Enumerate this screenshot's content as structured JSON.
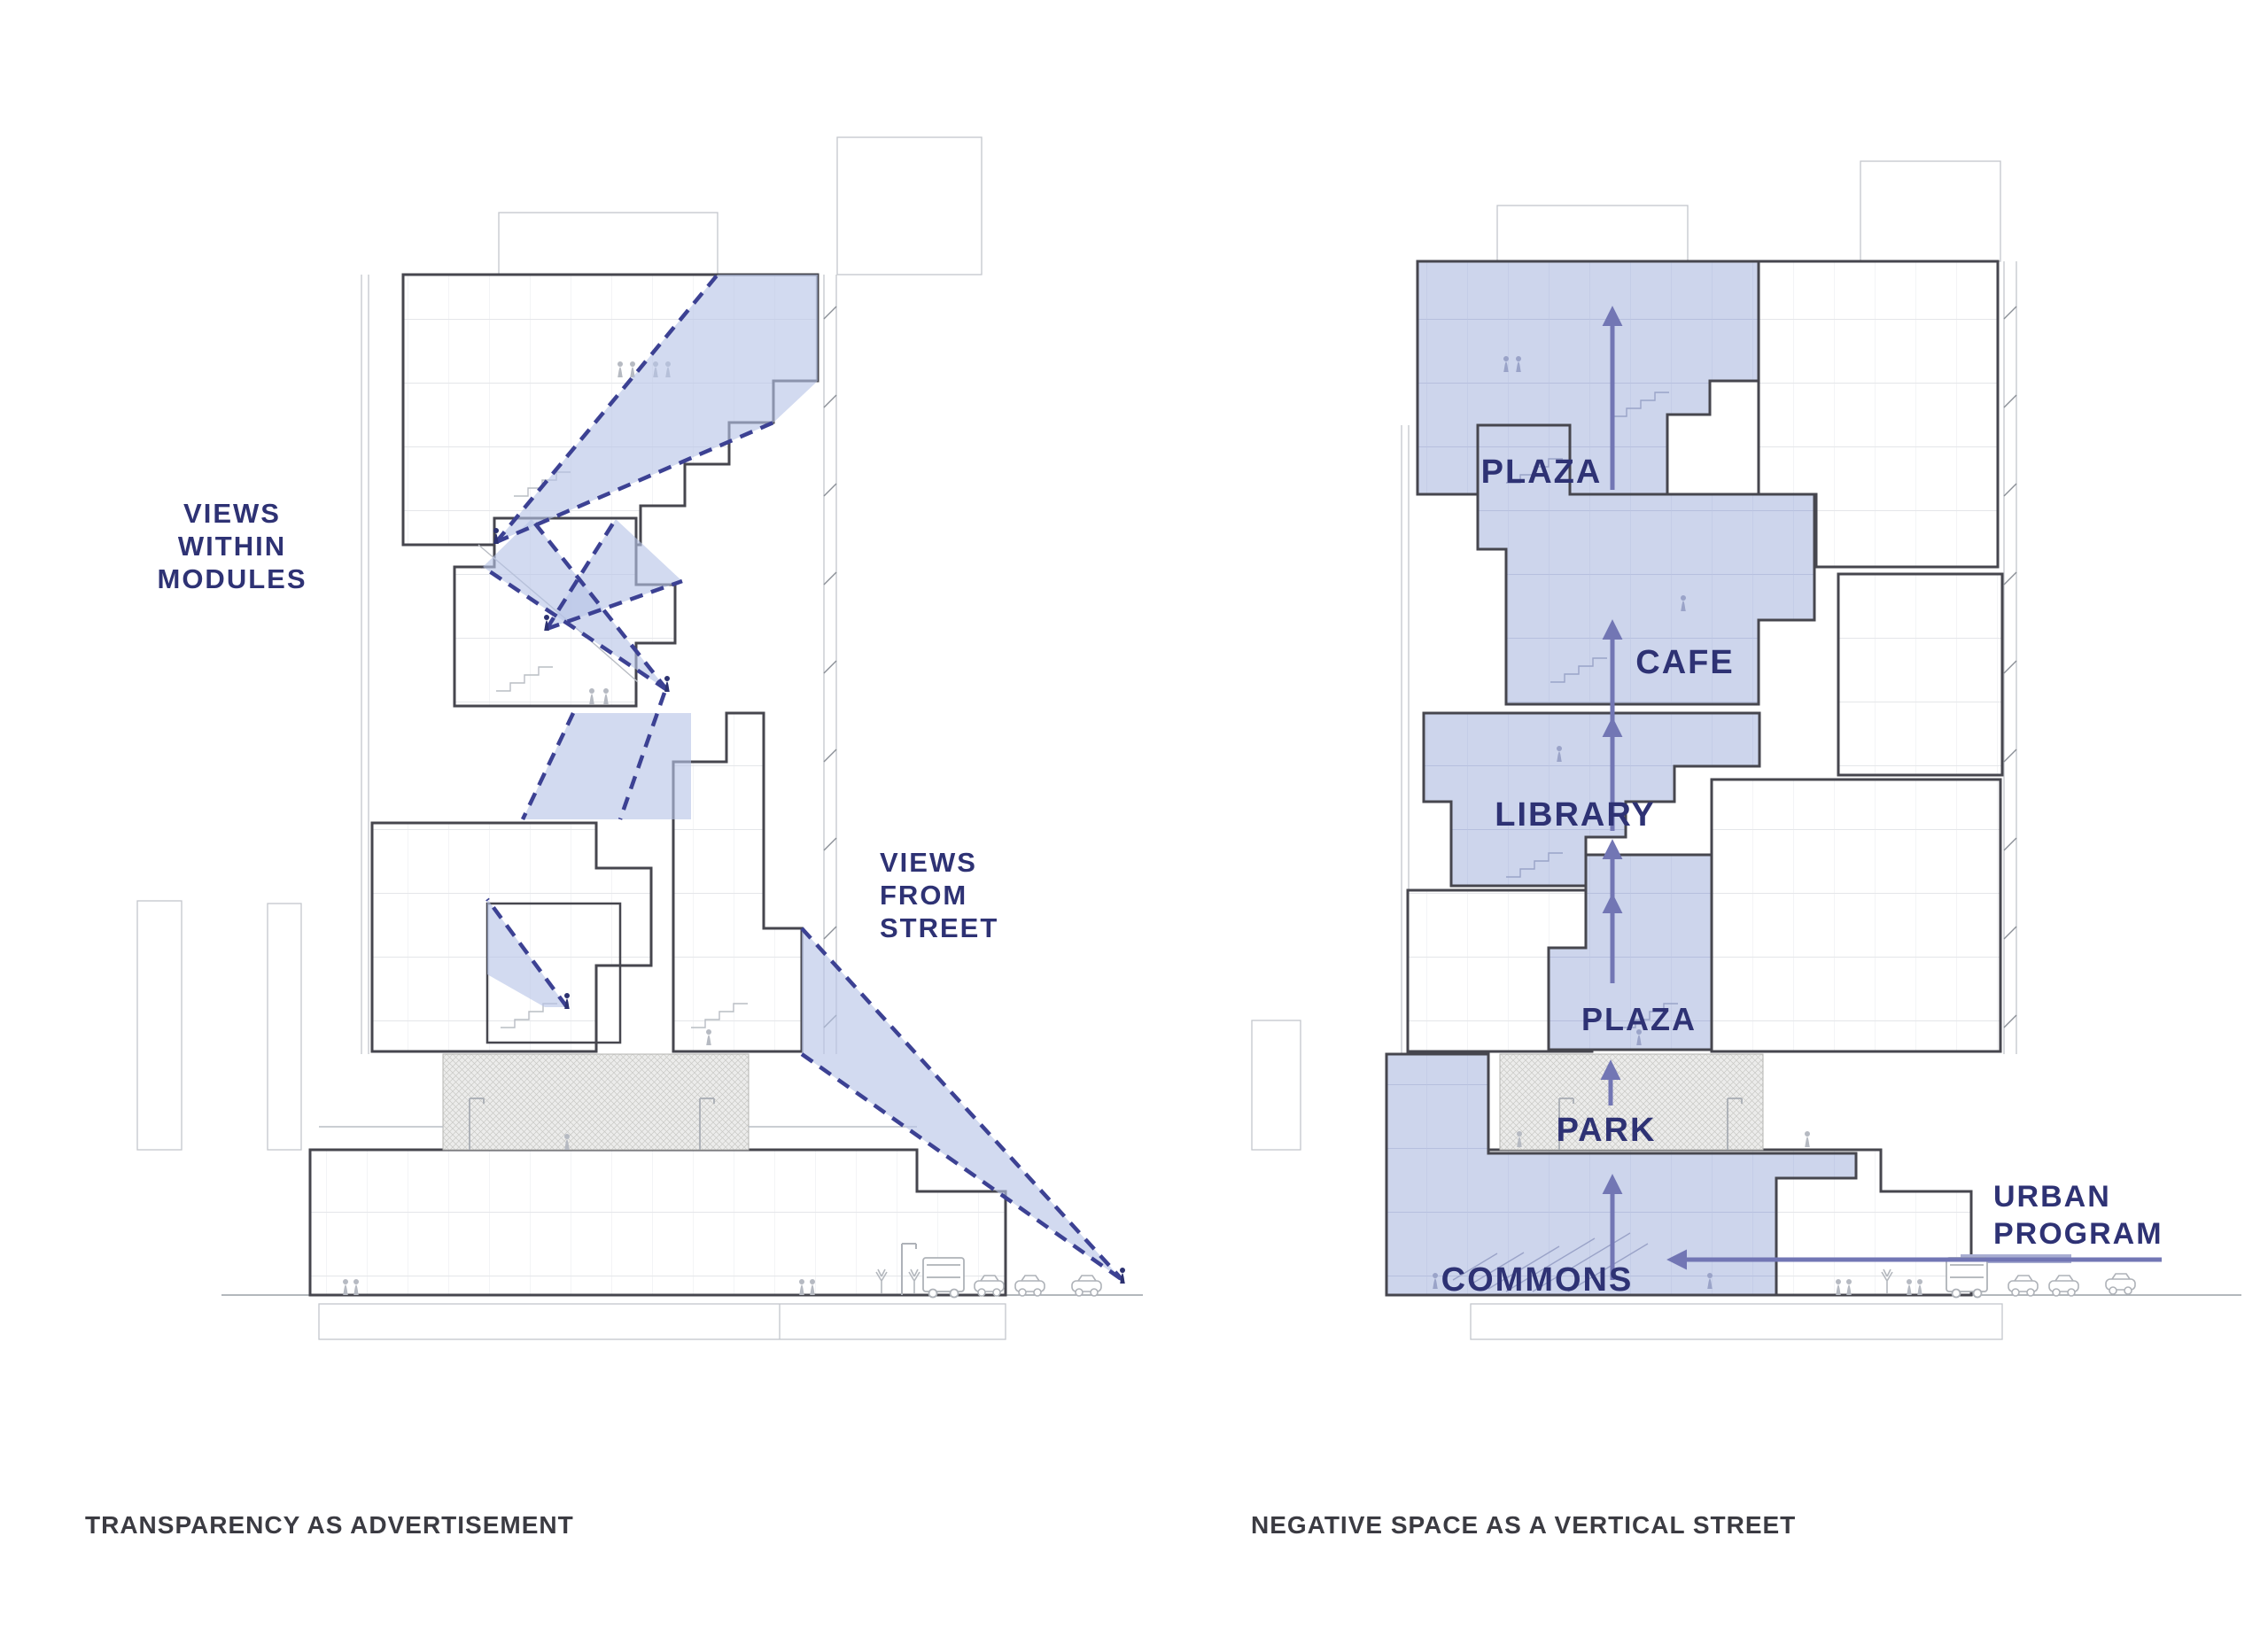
{
  "left": {
    "caption": "TRANSPARENCY AS ADVERTISEMENT",
    "views_within": {
      "line1": "VIEWS",
      "line2": "WITHIN",
      "line3": "MODULES"
    },
    "views_from": {
      "line1": "VIEWS",
      "line2": "FROM",
      "line3": "STREET"
    }
  },
  "right": {
    "caption": "NEGATIVE SPACE AS A VERTICAL STREET",
    "zones": {
      "plaza_top": "PLAZA",
      "cafe": "CAFE",
      "library": "LIBRARY",
      "plaza_mid": "PLAZA",
      "park": "PARK",
      "commons": "COMMONS"
    },
    "urban_program": {
      "line1": "URBAN",
      "line2": "PROGRAM"
    }
  },
  "colors": {
    "label_navy": "#2e3274",
    "caption_gray": "#3b3b42",
    "zone_fill": "#cdd5ec",
    "cone_fill": "rgba(183,195,230,0.62)",
    "cone_dash": "#3c4193",
    "arrow_purple": "#7276b4",
    "outline_dark": "#46464e"
  }
}
